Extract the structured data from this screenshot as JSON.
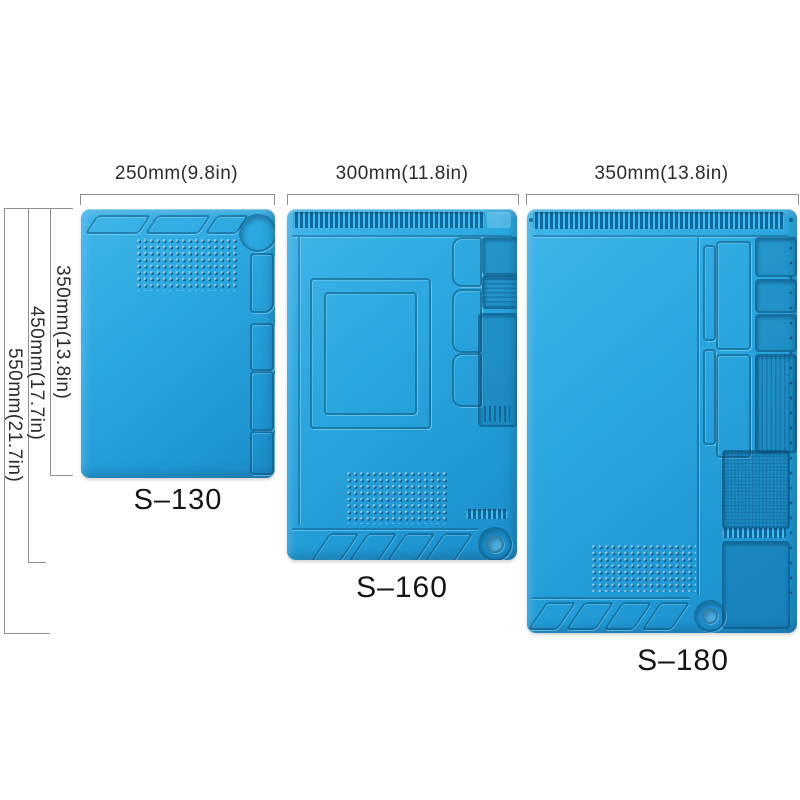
{
  "figure": {
    "title": "Size comparison of three blue silicone soldering repair work mats",
    "background": "#ffffff"
  },
  "colors": {
    "mat_blue": "#2aa6dd",
    "mat_blue_light": "#41b5e9",
    "mat_blue_dark": "#1b8cc8",
    "groove_dark": "#0c69a0",
    "label_text": "#141414",
    "dim_text": "#2b2b2b",
    "dim_line": "#8f8f8f"
  },
  "products": [
    {
      "model": "S–130",
      "width_label": "250mm(9.8in)",
      "height_label": "350mm(13.8in)"
    },
    {
      "model": "S–160",
      "width_label": "300mm(11.8in)",
      "height_label": "450mm(17.7in)"
    },
    {
      "model": "S–180",
      "width_label": "350mm(13.8in)",
      "height_label": "550mm(21.7in)"
    }
  ]
}
